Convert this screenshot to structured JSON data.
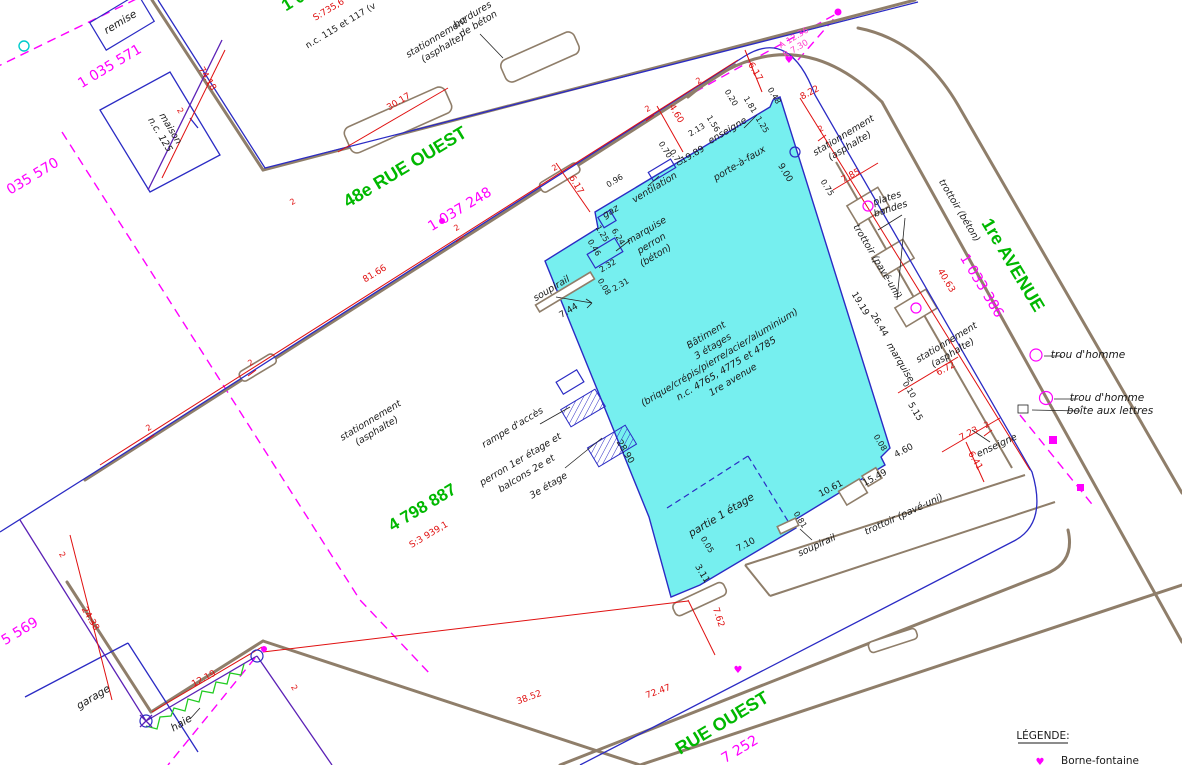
{
  "title": "Plan de localisation (plan cadastral)",
  "colors": {
    "street_green": "#00b800",
    "lot_magenta": "#ff00ff",
    "dim_red": "#e01010",
    "curb_brown": "#8f7e6a",
    "line_blue": "#2b2bc4",
    "boundary_purple": "#5b21b6",
    "building_cyan": "#76efef",
    "hedge_green": "#22cc22"
  },
  "streets": {
    "rue48": {
      "name": "48e RUE OUEST",
      "lot": "1 037 248"
    },
    "avenue1": {
      "name": "1re AVENUE",
      "lot": "1 033 386"
    },
    "rueOuest": {
      "name": "RUE OUEST",
      "lot": "7 252"
    }
  },
  "parcels": {
    "main": {
      "number": "4 798 887",
      "area": "S:3 939,1"
    },
    "p571": "1 035 571",
    "p570": "035 570",
    "p569": "5 569",
    "top": {
      "number": "1 03",
      "area": "S:735,6",
      "nc": "n.c. 115 et 117 (v"
    }
  },
  "building": {
    "lines": [
      "Bâtiment",
      "3 étages",
      "(brique/crépis/pierre/acier/aluminium)",
      "n.c. 4765, 4775 et 4785",
      "1re avenue"
    ],
    "partie": "partie 1 étage"
  },
  "features": {
    "stationnement_l1": "stationnement",
    "stationnement_l2": "(asphalte)",
    "trottoir_beton": "trottoir (béton)",
    "trottoir_pave": "trottoir (pavé-uni)",
    "bordures_l1": "bordures",
    "bordures_l2": "de béton",
    "plates_l1": "plates",
    "plates_l2": "bandes",
    "soupirail": "soupirail",
    "gaz": "gaz",
    "marquise": "marquise",
    "perron": "perron",
    "perron_mat": "(béton)",
    "ventilation": "ventilation",
    "enseigne": "enseigne",
    "porte_a_faux": "porte-à-faux",
    "trou_dhomme": "trou d'homme",
    "boite": "boîte aux lettres",
    "rampe": "rampe d'accès",
    "balcons_l1": "perron 1er étage et",
    "balcons_l2": "balcons 2e et",
    "balcons_l3": "3e étage",
    "haie": "haie",
    "maison_l1": "maison",
    "maison_l2": "n.c. 125",
    "remise": "remise",
    "garage": "garage"
  },
  "arc": {
    "a": "A 12.36",
    "r": "R 7.30"
  },
  "dims": {
    "tick": "2",
    "d74_18": "74.18",
    "d30_17": "30.17",
    "d81_66": "81.66",
    "d24_38": "24.38",
    "d12_19": "12.19",
    "d38_52": "38.52",
    "d72_47": "72.47",
    "d7_62": "7.62",
    "d8_22": "8.22",
    "d7_85": "7.85",
    "d40_63": "40.63",
    "d6_72": "6.72",
    "d7_23": "7.23",
    "d6_41": "6.41",
    "d6_17": "6.17",
    "d4_60": "4.60",
    "b19_89": "19.89",
    "b9_00": "9.00",
    "b2_13": "2.13",
    "b1_56": "1.56",
    "b1_25": "1.25",
    "b0_70": "0.70",
    "b0_20": "0.20",
    "b1_81": "1.81",
    "b0_48": "0.48",
    "b0_75": "0.75",
    "b0_96": "0.96",
    "b6_24": "6.24",
    "b0_46": "0.46",
    "b2_32": "2.32",
    "b0_08": "0.08",
    "b2_31": "2.31",
    "b7_44": "7.44",
    "b28_90": "28.90",
    "b19_19": "19.19",
    "b26_44": "26.44",
    "b0_10": "0.10",
    "b5_15": "5.15",
    "b15_49": "15.49",
    "b10_61": "10.61",
    "b7_10": "7.10",
    "b0_05": "0.05",
    "b3_11": "3.11",
    "b0_81": "0.81"
  },
  "legend": {
    "title": "LÉGENDE:",
    "item1": "Borne-fontaine"
  }
}
